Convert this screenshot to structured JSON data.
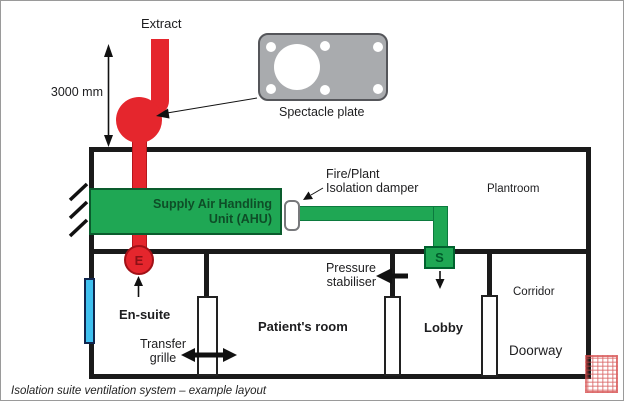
{
  "diagram": {
    "caption": "Isolation suite ventilation system – example layout",
    "labels": {
      "extract": "Extract",
      "dimension": "3000 mm",
      "spectacle_plate": "Spectacle plate",
      "fire_damper_line1": "Fire/Plant",
      "fire_damper_line2": "Isolation damper",
      "plantroom": "Plantroom",
      "ahu_line1": "Supply Air Handling",
      "ahu_line2": "Unit (AHU)",
      "extract_terminal": "E",
      "supply_terminal": "S",
      "pressure_line1": "Pressure",
      "pressure_line2": "stabiliser",
      "ensuite": "En-suite",
      "patients_room": "Patient's room",
      "transfer_line1": "Transfer",
      "transfer_line2": "grille",
      "lobby": "Lobby",
      "corridor": "Corridor",
      "doorway": "Doorway"
    },
    "colors": {
      "duct_red": "#e5262d",
      "red_dark": "#a11117",
      "supply_green": "#1fa754",
      "green_dark": "#00622e",
      "plate_gray": "#a9abae",
      "window_cyan": "#3fc0ef",
      "wall_black": "#1a1a1a",
      "stamp_red": "#d64949"
    }
  }
}
